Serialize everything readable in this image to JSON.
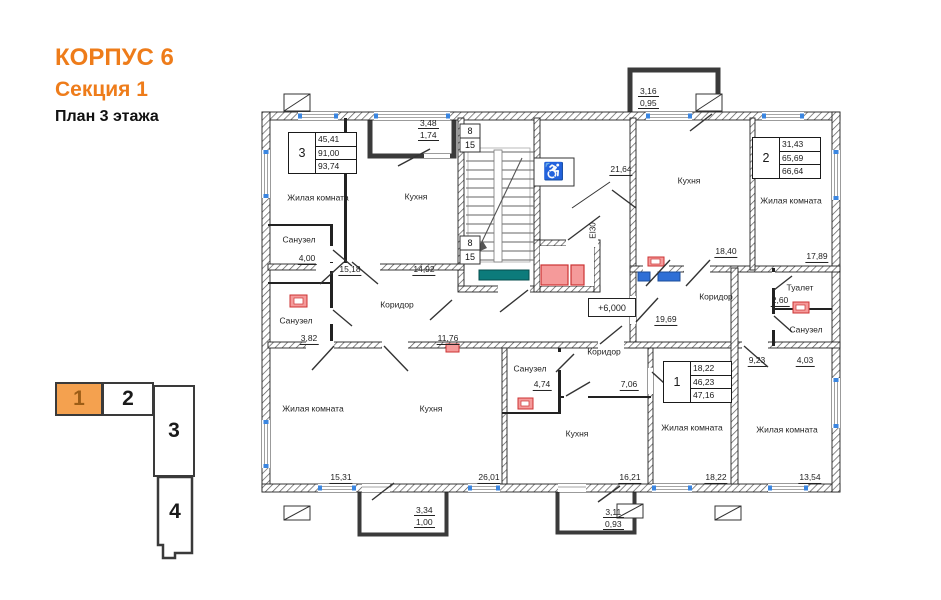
{
  "title": {
    "building": "КОРПУС 6",
    "section": "Секция 1",
    "plan": "План 3 этажа"
  },
  "key_plan": {
    "sections": [
      "1",
      "2",
      "3",
      "4"
    ],
    "active": "1"
  },
  "apartments": [
    {
      "number": "3",
      "living_area": "45,41",
      "apartment_area": "91,00",
      "total_area": "93,74"
    },
    {
      "number": "2",
      "living_area": "31,43",
      "apartment_area": "65,69",
      "total_area": "66,64"
    },
    {
      "number": "1",
      "living_area": "18,22",
      "apartment_area": "46,23",
      "total_area": "47,16"
    }
  ],
  "rooms": [
    {
      "name": "Жилая комната",
      "area": "15,18"
    },
    {
      "name": "Кухня",
      "area": "14,92"
    },
    {
      "name": "Санузел",
      "area": "4,00"
    },
    {
      "name": "Санузел",
      "area": "3,82"
    },
    {
      "name": "Коридор",
      "area": "11,76"
    },
    {
      "name": "Жилая комната",
      "area": "15,31"
    },
    {
      "name": "Кухня",
      "area": "26,01"
    },
    {
      "name": "Санузел",
      "area": "4,74"
    },
    {
      "name": "Коридор",
      "area": "7,06"
    },
    {
      "name": "Кухня",
      "area": "16,21"
    },
    {
      "name": "Жилая комната",
      "area": "18,22"
    },
    {
      "name": "Жилая комната",
      "area": "13,54"
    },
    {
      "name": "Коридор",
      "area": "9,23"
    },
    {
      "name": "Туалет",
      "area": "2,60"
    },
    {
      "name": "Санузел",
      "area": "4,03"
    },
    {
      "name": "Кухня",
      "area": "18,40"
    },
    {
      "name": "Жилая комната",
      "area": "17,89"
    }
  ],
  "balconies": [
    {
      "length": "3,48",
      "width": "1,74"
    },
    {
      "length": "3,16",
      "width": "0,95"
    },
    {
      "length": "3,34",
      "width": "1,00"
    },
    {
      "length": "3,11",
      "width": "0,93"
    }
  ],
  "marks": {
    "hall_area": "21,64",
    "entry_area": "19,69",
    "elevation": "+6,000",
    "elevator_fire_rating": "EI30",
    "stair_flight_width": "8",
    "stair_steps": "15",
    "wheelchair_symbol": "♿"
  },
  "colors": {
    "accent_orange": "#ee7c1a",
    "key_active_fill": "#f4a14f",
    "glazing_blue": "#3b86e0",
    "elevator_pink": "#f59a9a",
    "elevator_red": "#cc3333",
    "bench_teal": "#0c7b7b",
    "appliance_blue": "#2f6fd6"
  }
}
